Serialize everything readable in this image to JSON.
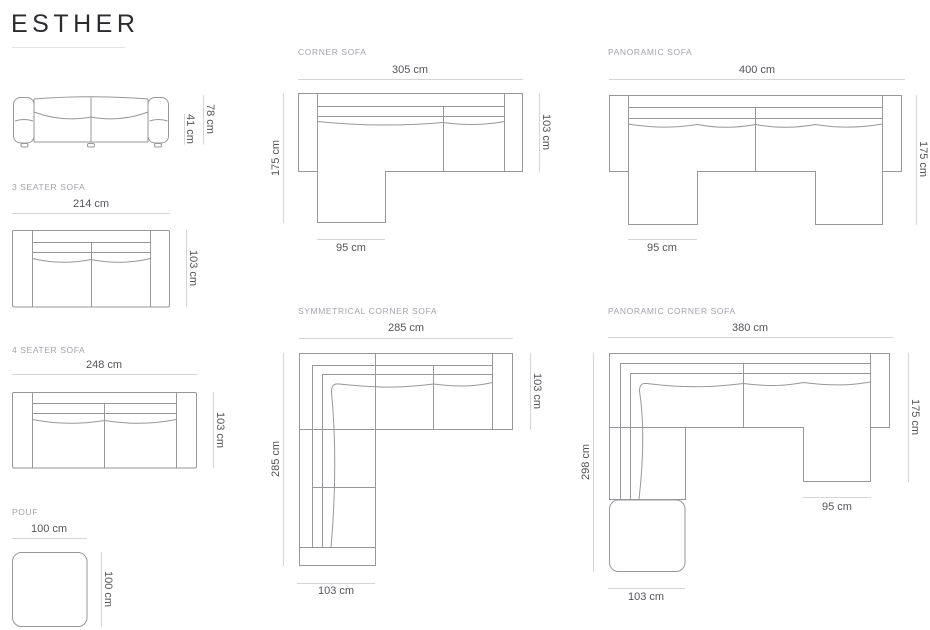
{
  "brand": {
    "title": "ESTHER"
  },
  "sections": {
    "front": {
      "total_height": "78 cm",
      "seat_height": "41 cm"
    },
    "three_seater": {
      "label": "3 SEATER SOFA",
      "width": "214 cm",
      "depth": "103 cm"
    },
    "four_seater": {
      "label": "4 SEATER SOFA",
      "width": "248 cm",
      "depth": "103 cm"
    },
    "pouf": {
      "label": "POUF",
      "width": "100 cm",
      "depth": "100 cm"
    },
    "corner": {
      "label": "CORNER SOFA",
      "width": "305 cm",
      "depth": "103 cm",
      "total_depth": "175 cm",
      "chaise_width": "95 cm"
    },
    "panoramic": {
      "label": "PANORAMIC SOFA",
      "width": "400 cm",
      "total_depth": "175 cm",
      "chaise_width": "95 cm"
    },
    "symmetrical_corner": {
      "label": "SYMMETRICAL CORNER SOFA",
      "width": "285 cm",
      "depth": "103 cm",
      "side_length": "285 cm",
      "side_width": "103 cm"
    },
    "panoramic_corner": {
      "label": "PANORAMIC CORNER SOFA",
      "width": "380 cm",
      "total_depth": "175 cm",
      "chaise_width": "95 cm",
      "side_length": "298 cm",
      "side_width": "103 cm"
    }
  },
  "colors": {
    "title_text": "#2b2b30",
    "dimension_text": "#54545b",
    "section_label_text": "#a3a3ab",
    "drawing_line": "#97979c",
    "dimension_line": "#d5d5d8",
    "background": "#ffffff"
  }
}
